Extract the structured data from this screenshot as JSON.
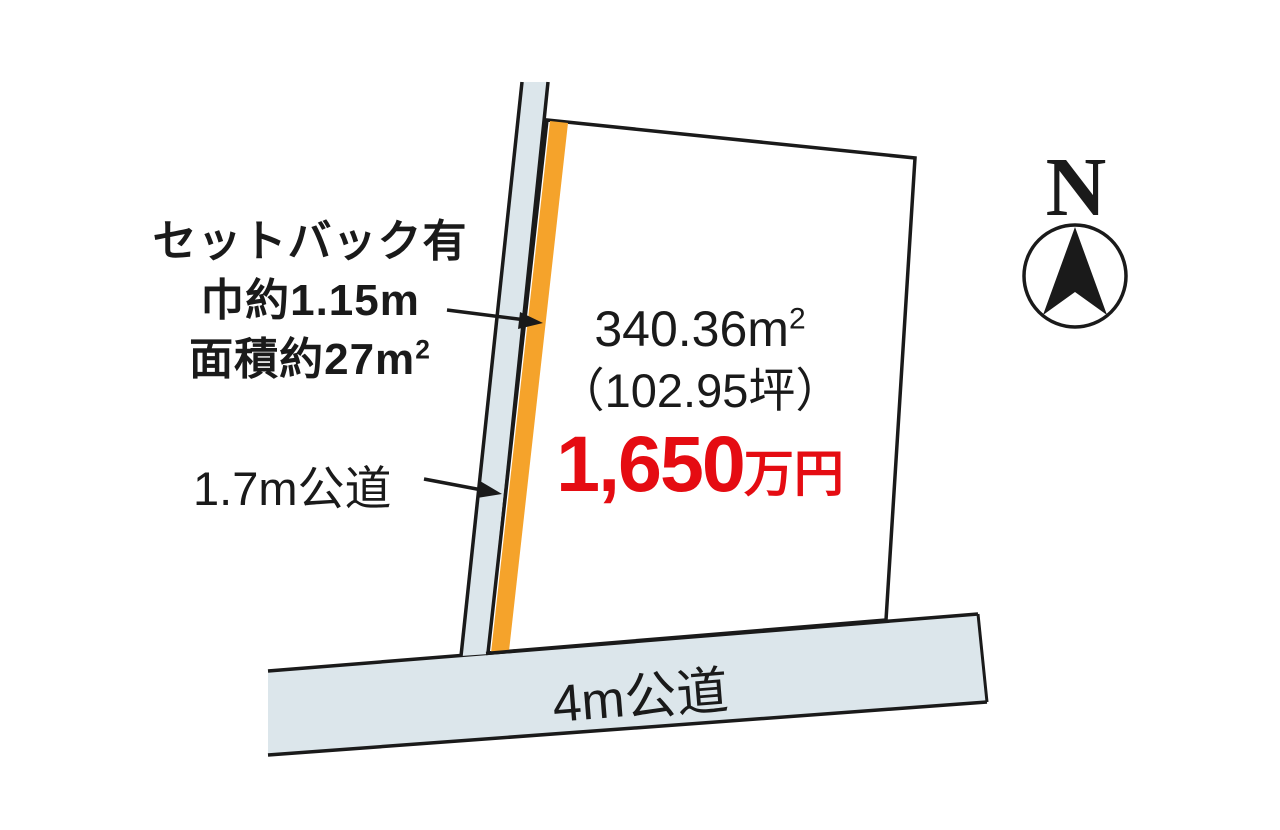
{
  "diagram": {
    "title_hint": "land plot sales diagram",
    "setback_note": {
      "line1": "セットバック有",
      "line2": "巾約1.15m",
      "line3_main": "面積約27m",
      "line3_sup": "2"
    },
    "side_road": {
      "label": "1.7m公道"
    },
    "bottom_road": {
      "label": "4m公道"
    },
    "parcel": {
      "area_m2_main": "340.36m",
      "area_m2_sup": "2",
      "area_tsubo": "（102.95坪）",
      "price_amount": "1,650",
      "price_unit": "万円"
    },
    "compass": {
      "label": "N"
    },
    "colors": {
      "road_fill": "#dce6eb",
      "setback_fill": "#f5a32b",
      "price_red": "#e50c12",
      "line_black": "#1a1a1a"
    }
  }
}
